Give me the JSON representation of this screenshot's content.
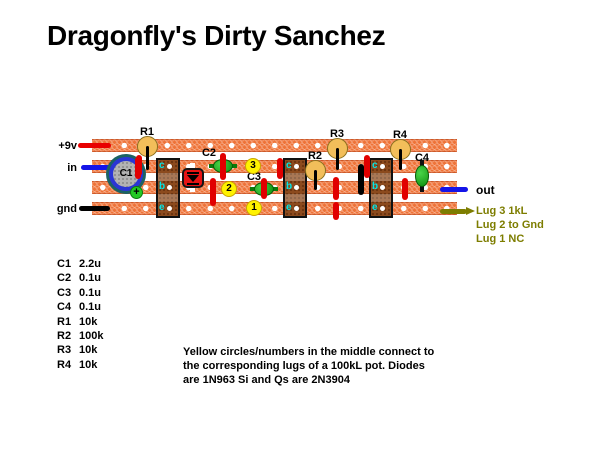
{
  "title": "Dragonfly's Dirty Sanchez",
  "io_labels": {
    "power": "+9v",
    "input": "in",
    "ground": "gnd",
    "output": "out"
  },
  "pot_lugs": [
    "Lug 3 1kL",
    "Lug 2 to Gnd",
    "Lug 1 NC"
  ],
  "refs": {
    "c1": "C1",
    "c2": "C2",
    "c3": "C3",
    "c4": "C4",
    "r1": "R1",
    "r2": "R2",
    "r3": "R3",
    "r4": "R4"
  },
  "pins": {
    "c": "c",
    "b": "b",
    "e": "e"
  },
  "pot_points": {
    "p1": "1",
    "p2": "2",
    "p3": "3"
  },
  "c1_polarity": "+",
  "parts_list": [
    {
      "ref": "C1",
      "value": "2.2u"
    },
    {
      "ref": "C2",
      "value": "0.1u"
    },
    {
      "ref": "C3",
      "value": "0.1u"
    },
    {
      "ref": "C4",
      "value": "0.1u"
    },
    {
      "ref": "R1",
      "value": "10k"
    },
    {
      "ref": "R2",
      "value": "100k"
    },
    {
      "ref": "R3",
      "value": "10k"
    },
    {
      "ref": "R4",
      "value": "10k"
    }
  ],
  "note_lines": [
    "Yellow circles/numbers in the middle connect to",
    "the corresponding lugs of a 100kL pot.  Diodes",
    "are 1N963 Si and Qs are 2N3904"
  ],
  "colors": {
    "strip_orange": "#EE7338",
    "wire_red": "#E80000",
    "wire_blue": "#1414E8",
    "wire_black": "#000000",
    "lug_olive": "#7D7D00",
    "resistor_body": "#F2BE5A",
    "capacitor_green": "#1DB41D",
    "transistor_brown": "#8C4A1D",
    "pot_yellow": "#FFF200",
    "diode_red": "#E81414"
  }
}
